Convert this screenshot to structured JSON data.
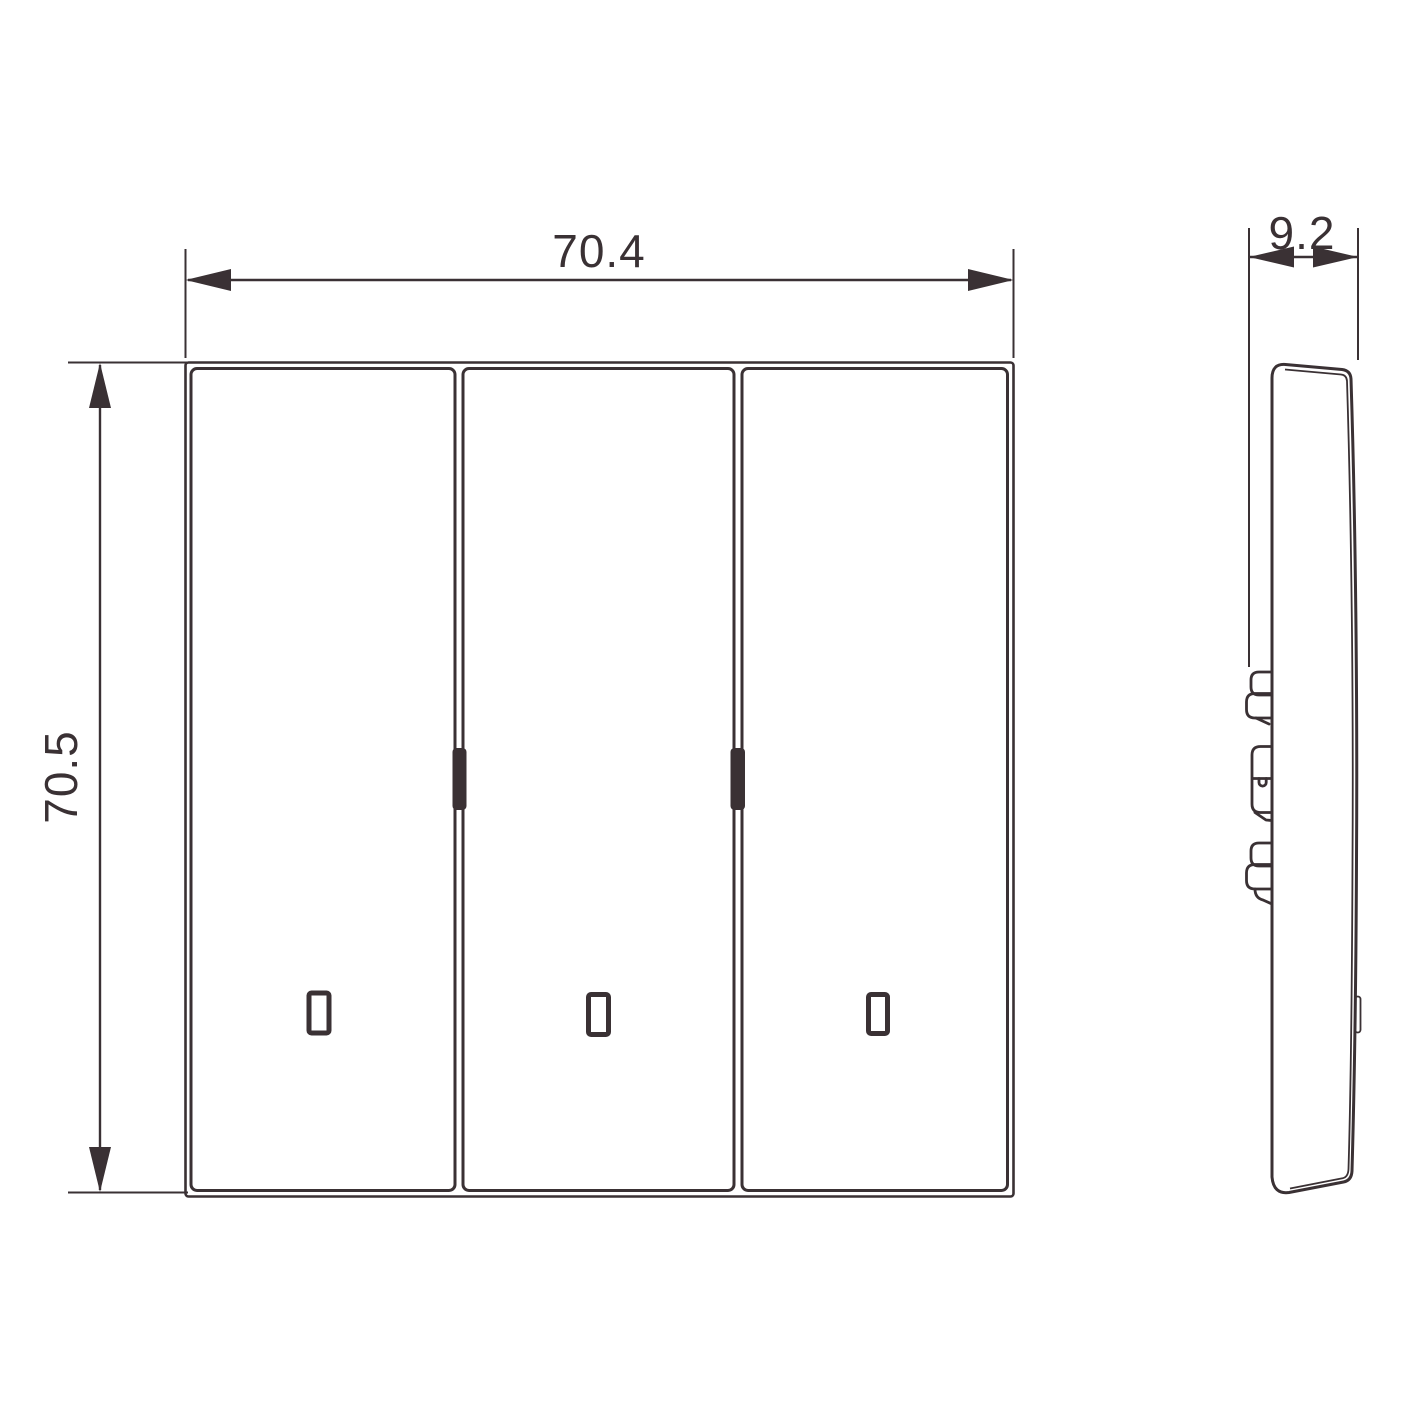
{
  "drawing": {
    "background_color": "#ffffff",
    "line_color": "#3a3134",
    "dim_width": {
      "label": "70.4"
    },
    "dim_height": {
      "label": "70.5"
    },
    "dim_depth": {
      "label": "9.2"
    }
  }
}
